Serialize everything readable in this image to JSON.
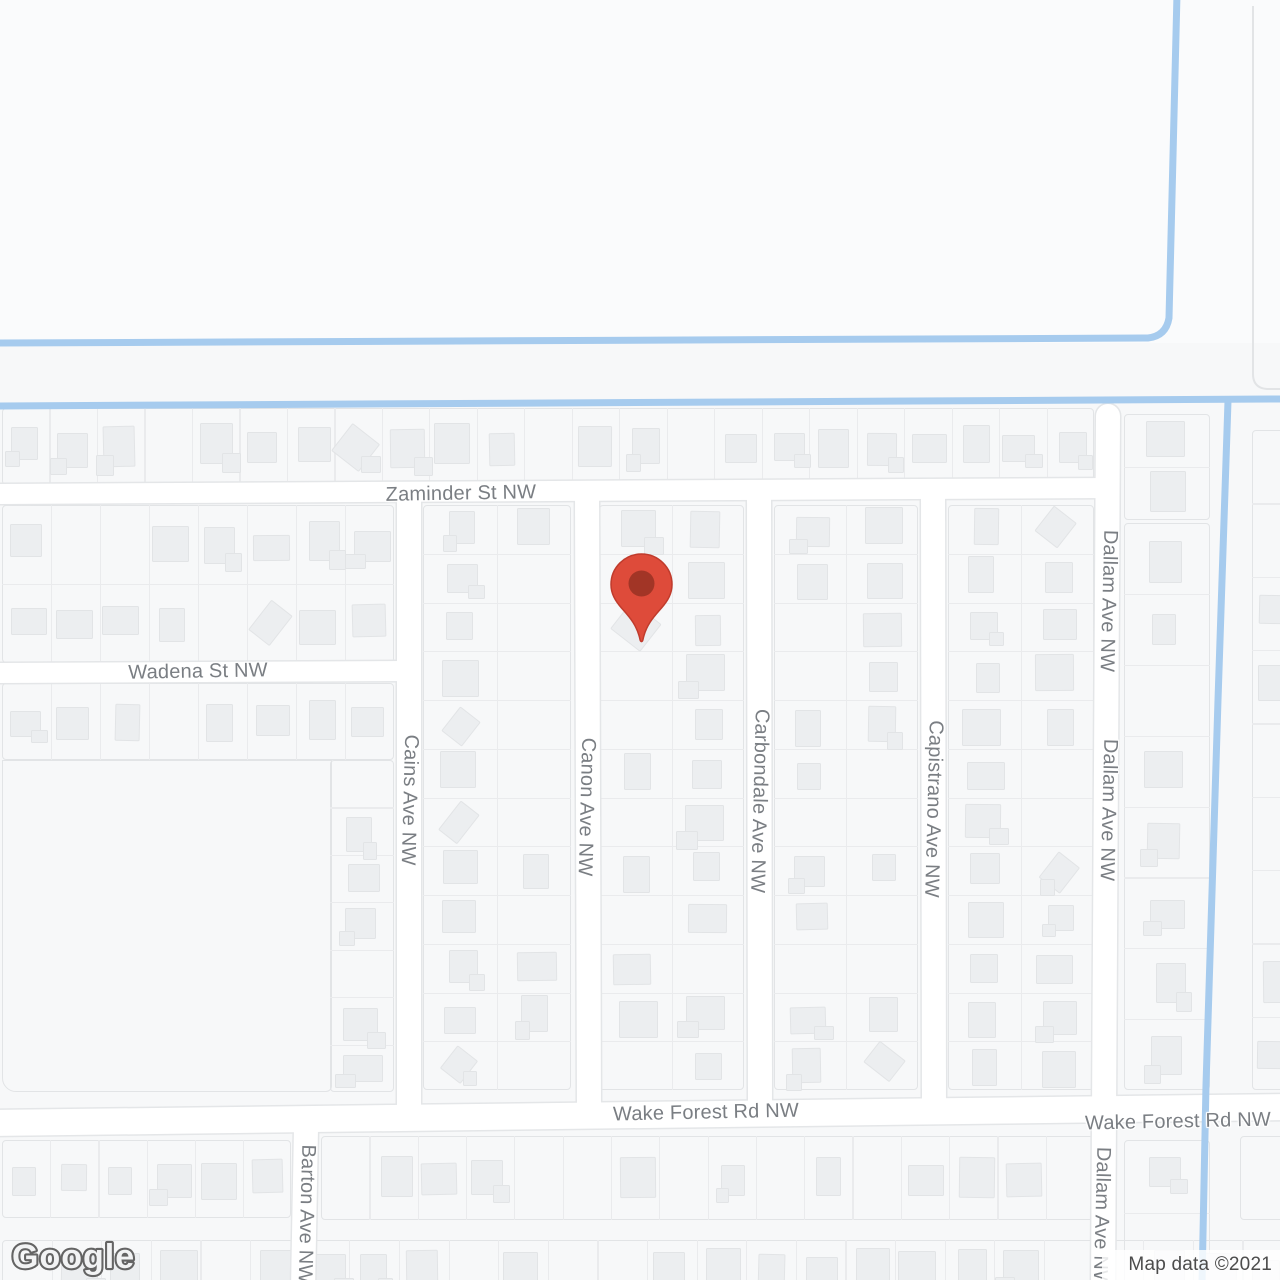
{
  "map": {
    "attribution": "Map data ©2021",
    "logo_text": "Google",
    "colors": {
      "background": "#f7f8f9",
      "background_top": "#fafbfc",
      "road_fill": "#ffffff",
      "road_casing": "#e4e6e8",
      "parcel_line": "#eaebed",
      "block_border": "#e2e4e6",
      "building_fill": "#eceef0",
      "water": "#a6cbee",
      "label_text": "#7a7e83",
      "attribution_text": "#4c4c4c",
      "marker_fill": "#de4b3a",
      "marker_stroke": "#c03b2c",
      "marker_dot": "#a23526"
    },
    "marker": {
      "x": 641,
      "tip_y": 641,
      "balloon_top_y": 554
    },
    "water_lines": [
      {
        "name": "canal-north-loop",
        "path": "M 1177 -6 L 1169 318 Q 1166 336 1148 338 L 0 343"
      },
      {
        "name": "canal-mid",
        "path": "M 0 406 L 1280 399"
      },
      {
        "name": "canal-east-branch",
        "path": "M 1228 401 L 1218 700 L 1206 1085 L 1202 1284"
      }
    ],
    "roads": [
      {
        "name": "Zaminder St NW",
        "x1": -10,
        "y1": 494,
        "x2": 1110,
        "y2": 488,
        "width": 20,
        "cap": "butt"
      },
      {
        "name": "Wadena St NW",
        "x1": -10,
        "y1": 673,
        "x2": 412,
        "y2": 671,
        "width": 20,
        "cap": "butt"
      },
      {
        "name": "Wake Forest Rd NW",
        "x1": -10,
        "y1": 1123,
        "x2": 1290,
        "y2": 1107,
        "width": 26,
        "cap": "butt"
      },
      {
        "name": "Cains Ave NW",
        "x1": 409,
        "y1": 492,
        "x2": 409,
        "y2": 1112,
        "width": 24,
        "cap": "butt"
      },
      {
        "name": "Canon Ave NW",
        "x1": 587,
        "y1": 492,
        "x2": 589,
        "y2": 1112,
        "width": 24,
        "cap": "butt"
      },
      {
        "name": "Carbondale Ave NW",
        "x1": 759,
        "y1": 490,
        "x2": 760,
        "y2": 1114,
        "width": 24,
        "cap": "butt"
      },
      {
        "name": "Capistrano Ave NW",
        "x1": 933,
        "y1": 490,
        "x2": 934,
        "y2": 1116,
        "width": 24,
        "cap": "butt"
      },
      {
        "name": "Dallam Ave NW",
        "x1": 1108,
        "y1": 416,
        "x2": 1103,
        "y2": 1290,
        "width": 24,
        "cap": "round"
      },
      {
        "name": "Barton Ave NW",
        "x1": 306,
        "y1": 1128,
        "x2": 303,
        "y2": 1290,
        "width": 24,
        "cap": "butt"
      }
    ],
    "labels": [
      {
        "text": "Zaminder St NW",
        "x": 461,
        "y": 494,
        "angle": -1
      },
      {
        "text": "Wadena St NW",
        "x": 198,
        "y": 672,
        "angle": -1
      },
      {
        "text": "Wake Forest Rd NW",
        "x": 706,
        "y": 1113,
        "angle": -1.2
      },
      {
        "text": "Wake Forest Rd NW",
        "x": 1178,
        "y": 1122,
        "angle": -1.2
      },
      {
        "text": "Cains Ave NW",
        "x": 409,
        "y": 800,
        "angle": 91.5
      },
      {
        "text": "Canon Ave NW",
        "x": 586,
        "y": 807,
        "angle": 91.5
      },
      {
        "text": "Carbondale Ave NW",
        "x": 759,
        "y": 801,
        "angle": 91.5
      },
      {
        "text": "Capistrano Ave NW",
        "x": 933,
        "y": 809,
        "angle": 91.5
      },
      {
        "text": "Dallam Ave NW",
        "x": 1108,
        "y": 601,
        "angle": 91.5
      },
      {
        "text": "Dallam Ave NW",
        "x": 1108,
        "y": 810,
        "angle": 91.5
      },
      {
        "text": "Dallam Ave NW",
        "x": 1101,
        "y": 1218,
        "angle": 91.5
      },
      {
        "text": "Barton Ave NW",
        "x": 306,
        "y": 1214,
        "angle": 91.5
      }
    ]
  }
}
